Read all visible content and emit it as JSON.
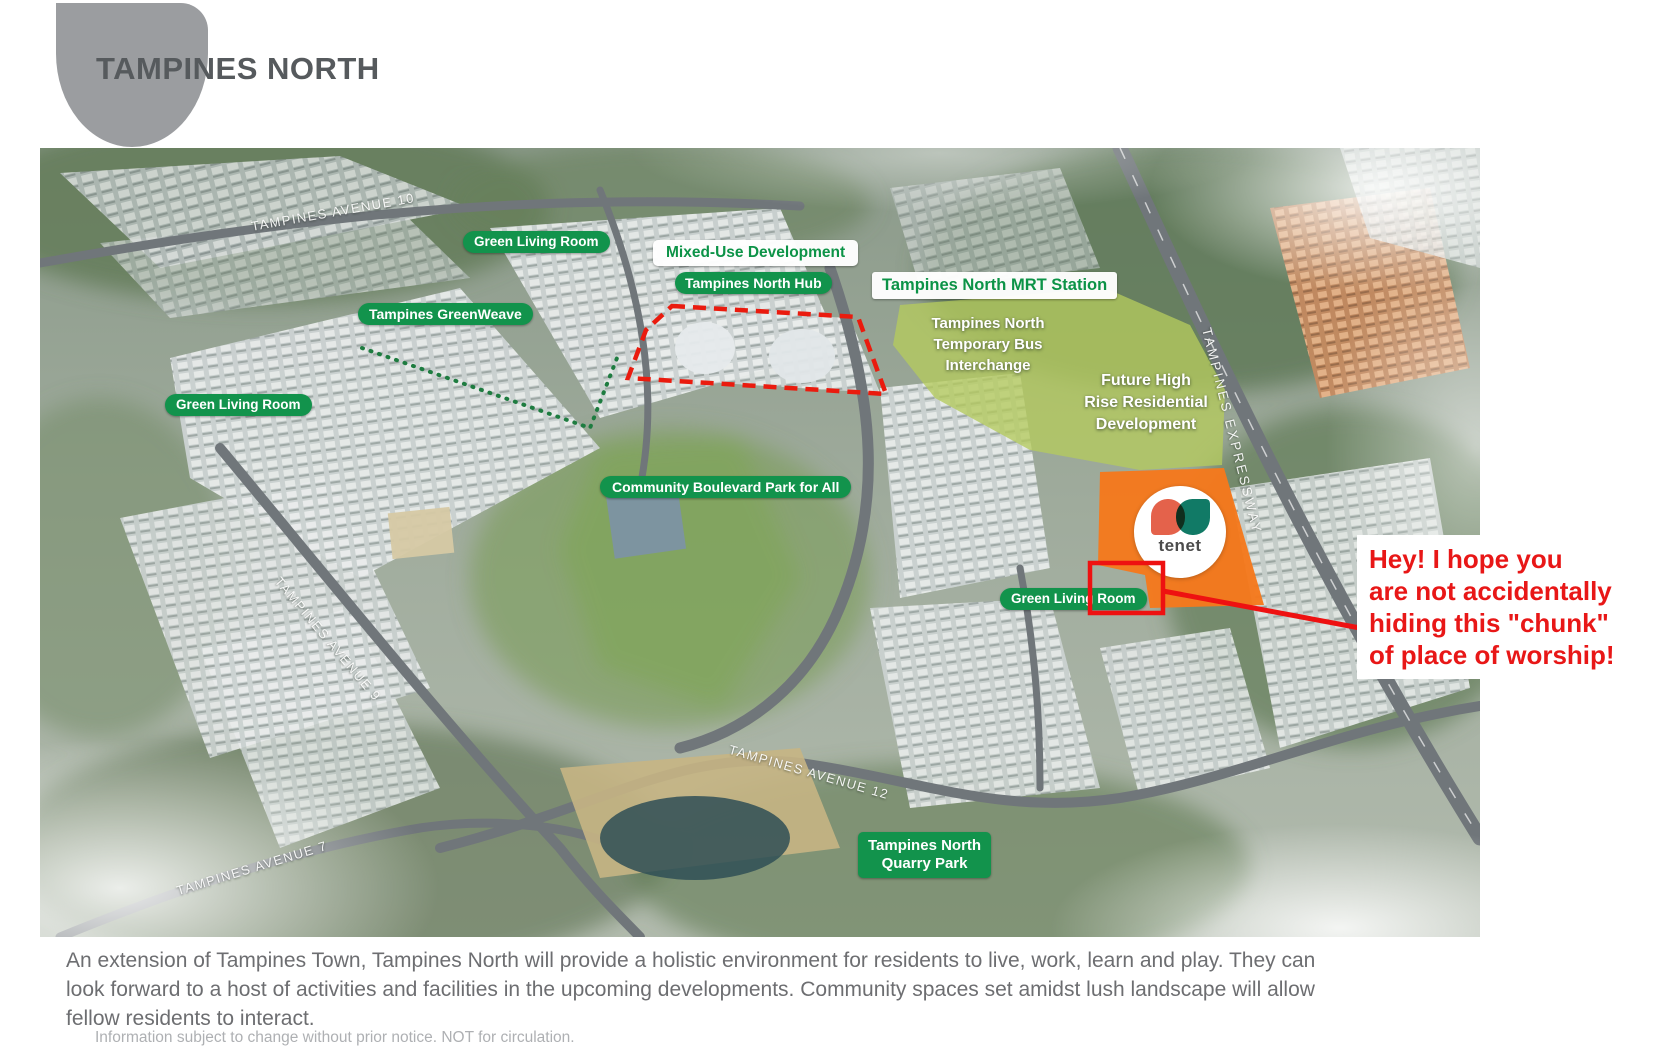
{
  "header": {
    "title": "TAMPINES NORTH"
  },
  "map_labels": {
    "green_living_room_1": "Green Living Room",
    "mixed_use_development": "Mixed-Use Development",
    "tampines_north_hub": "Tampines North Hub",
    "mrt_station": "Tampines North MRT Station",
    "tampines_greenweave": "Tampines GreenWeave",
    "green_living_room_2": "Green Living Room",
    "bus_interchange_lines": [
      "Tampines North",
      "Temporary Bus",
      "Interchange"
    ],
    "future_development_lines": [
      "Future High",
      "Rise Residential",
      "Development"
    ],
    "community_boulevard": "Community Boulevard Park for All",
    "green_living_room_3": "Green Living Room",
    "quarry_park_lines": [
      "Tampines North",
      "Quarry Park"
    ]
  },
  "road_labels": {
    "avenue_10": "TAMPINES AVENUE 10",
    "avenue_9": "TAMPINES AVENUE 9",
    "avenue_7": "TAMPINES AVENUE 7",
    "avenue_12": "TAMPINES AVENUE 12",
    "expressway": "TAMPINES EXPRESSWAY"
  },
  "tenet_logo": {
    "label": "tenet"
  },
  "annotation": {
    "lines": [
      "Hey! I hope you",
      "are not accidentally",
      "hiding this \"chunk\"",
      "of place of worship!"
    ]
  },
  "caption": {
    "text": "An extension of Tampines Town, Tampines North will provide a holistic environment for residents to live, work, learn and play. They can look forward to a host of activities and facilities in the upcoming developments. Community spaces set amidst lush landscape will allow fellow residents to interact."
  },
  "fineprint": {
    "text": "Information subject to change without prior notice. NOT for circulation."
  },
  "colors": {
    "label_green": "#12934c",
    "white_label_text_green": "#0c9347",
    "highlight_red": "#ee1111",
    "annotation_red": "#e81717",
    "parcel_orange": "#f5791d",
    "future_overlay_green": "#b5cb5d",
    "title_gray": "#565a5d"
  }
}
